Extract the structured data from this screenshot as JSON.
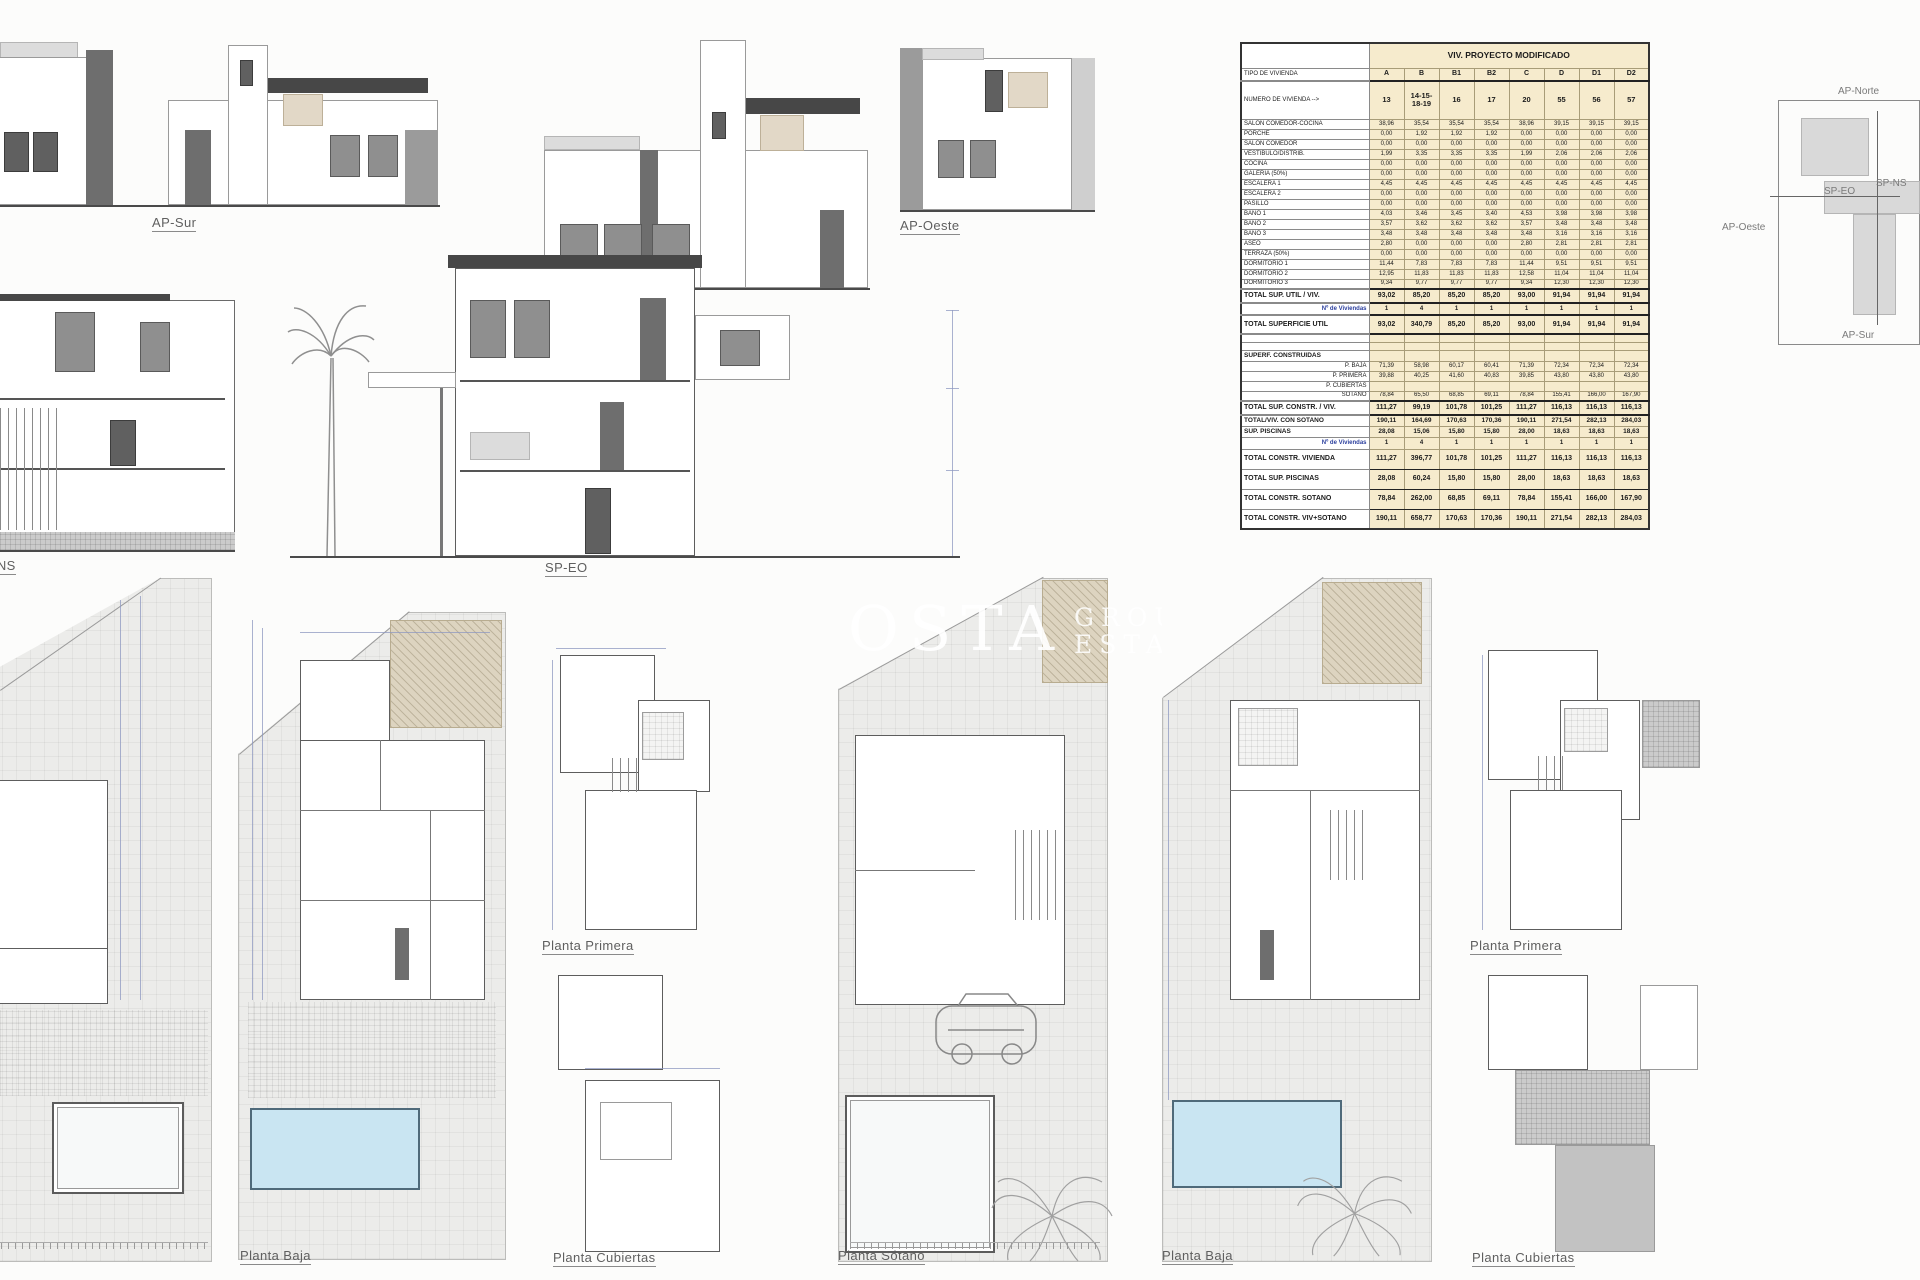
{
  "elevation_labels": {
    "ap_sur": "AP-Sur",
    "ap_norte": "AP-Norte",
    "ap_oeste": "AP-Oeste",
    "sp_ns": "SP-NS",
    "sp_eo": "SP-EO"
  },
  "plan_labels": {
    "sotano_left": "Planta Sótano",
    "baja_left": "Planta Baja",
    "primera_left": "Planta Primera",
    "cubiertas_left": "Planta Cubiertas",
    "sotano_mid": "Planta Sótano",
    "baja_right": "Planta Baja",
    "primera_right": "Planta Primera",
    "cubiertas_right": "Planta Cubiertas"
  },
  "site_key": {
    "ap_norte": "AP-Norte",
    "ap_oeste": "AP-Oeste",
    "ap_sur": "AP-Sur",
    "sp_ns": "SP-NS",
    "sp_eo": "SP-EO"
  },
  "watermark": {
    "big": "OSTA",
    "group": "GROUP",
    "estates": "ESTATES"
  },
  "colors": {
    "table_fill": "#f6ebcd",
    "pool_water": "#c9e5f2",
    "hatch_tan": "#ddd4c0",
    "nviv_blue": "#2b3f9e"
  },
  "table": {
    "title": "VIV. PROYECTO MODIFICADO",
    "rows": [
      {
        "style": "title",
        "label": "",
        "value": "VIV. PROYECTO MODIFICADO"
      },
      {
        "style": "head",
        "label": "TIPO DE VIVIENDA",
        "values": [
          "A",
          "B",
          "B1",
          "B2",
          "C",
          "D",
          "D1",
          "D2"
        ]
      },
      {
        "style": "numero",
        "label": "NUMERO DE VIVIENDA -->",
        "values": [
          "13",
          "14-15-18-19",
          "16",
          "17",
          "20",
          "55",
          "56",
          "57"
        ]
      },
      {
        "style": "room",
        "label": "SALON COMEDOR-COCINA",
        "values": [
          "38,96",
          "35,54",
          "35,54",
          "35,54",
          "38,96",
          "39,15",
          "39,15",
          "39,15"
        ]
      },
      {
        "style": "room",
        "label": "PORCHE",
        "values": [
          "0,00",
          "1,92",
          "1,92",
          "1,92",
          "0,00",
          "0,00",
          "0,00",
          "0,00"
        ]
      },
      {
        "style": "room",
        "label": "SALON COMEDOR",
        "values": [
          "0,00",
          "0,00",
          "0,00",
          "0,00",
          "0,00",
          "0,00",
          "0,00",
          "0,00"
        ]
      },
      {
        "style": "room",
        "label": "VESTIBULO/DISTRIB.",
        "values": [
          "1,99",
          "3,35",
          "3,35",
          "3,35",
          "1,99",
          "2,06",
          "2,06",
          "2,06"
        ]
      },
      {
        "style": "room",
        "label": "COCINA",
        "values": [
          "0,00",
          "0,00",
          "0,00",
          "0,00",
          "0,00",
          "0,00",
          "0,00",
          "0,00"
        ]
      },
      {
        "style": "room",
        "label": "GALERIA (50%)",
        "values": [
          "0,00",
          "0,00",
          "0,00",
          "0,00",
          "0,00",
          "0,00",
          "0,00",
          "0,00"
        ]
      },
      {
        "style": "room",
        "label": "ESCALERA 1",
        "values": [
          "4,45",
          "4,45",
          "4,45",
          "4,45",
          "4,45",
          "4,45",
          "4,45",
          "4,45"
        ]
      },
      {
        "style": "room",
        "label": "ESCALERA 2",
        "values": [
          "0,00",
          "0,00",
          "0,00",
          "0,00",
          "0,00",
          "0,00",
          "0,00",
          "0,00"
        ]
      },
      {
        "style": "room",
        "label": "PASILLO",
        "values": [
          "0,00",
          "0,00",
          "0,00",
          "0,00",
          "0,00",
          "0,00",
          "0,00",
          "0,00"
        ]
      },
      {
        "style": "room",
        "label": "BAÑO 1",
        "values": [
          "4,03",
          "3,46",
          "3,45",
          "3,40",
          "4,53",
          "3,98",
          "3,98",
          "3,98"
        ]
      },
      {
        "style": "room",
        "label": "BAÑO 2",
        "values": [
          "3,57",
          "3,62",
          "3,62",
          "3,62",
          "3,57",
          "3,48",
          "3,48",
          "3,48"
        ]
      },
      {
        "style": "room",
        "label": "BAÑO 3",
        "values": [
          "3,48",
          "3,48",
          "3,48",
          "3,48",
          "3,48",
          "3,16",
          "3,16",
          "3,16"
        ]
      },
      {
        "style": "room",
        "label": "ASEO",
        "values": [
          "2,80",
          "0,00",
          "0,00",
          "0,00",
          "2,80",
          "2,81",
          "2,81",
          "2,81"
        ]
      },
      {
        "style": "room",
        "label": "TERRAZA (50%)",
        "values": [
          "0,00",
          "0,00",
          "0,00",
          "0,00",
          "0,00",
          "0,00",
          "0,00",
          "0,00"
        ]
      },
      {
        "style": "room",
        "label": "DORMITORIO 1",
        "values": [
          "11,44",
          "7,83",
          "7,83",
          "7,83",
          "11,44",
          "9,51",
          "9,51",
          "9,51"
        ]
      },
      {
        "style": "room",
        "label": "DORMITORIO 2",
        "values": [
          "12,95",
          "11,83",
          "11,83",
          "11,83",
          "12,58",
          "11,04",
          "11,04",
          "11,04"
        ]
      },
      {
        "style": "room",
        "label": "DORMITORIO 3",
        "values": [
          "9,34",
          "9,77",
          "9,77",
          "9,77",
          "9,34",
          "12,30",
          "12,30",
          "12,30"
        ]
      },
      {
        "style": "total",
        "label": "TOTAL SUP. UTIL / VIV.",
        "values": [
          "93,02",
          "85,20",
          "85,20",
          "85,20",
          "93,00",
          "91,94",
          "91,94",
          "91,94"
        ]
      },
      {
        "style": "nviv",
        "label": "Nº de Viviendas",
        "values": [
          "1",
          "4",
          "1",
          "1",
          "1",
          "1",
          "1",
          "1"
        ]
      },
      {
        "style": "tsu",
        "label": "TOTAL SUPERFICIE UTIL",
        "values": [
          "93,02",
          "340,79",
          "85,20",
          "85,20",
          "93,00",
          "91,94",
          "91,94",
          "91,94"
        ]
      },
      {
        "style": "spacer",
        "label": "",
        "values": [
          "",
          "",
          "",
          "",
          "",
          "",
          "",
          ""
        ]
      },
      {
        "style": "spacer",
        "label": "",
        "values": [
          "",
          "",
          "",
          "",
          "",
          "",
          "",
          ""
        ]
      },
      {
        "style": "section",
        "label": "SUPERF. CONSTRUIDAS",
        "values": [
          "",
          "",
          "",
          "",
          "",
          "",
          "",
          ""
        ]
      },
      {
        "style": "sub",
        "label": "P. BAJA",
        "values": [
          "71,39",
          "58,98",
          "60,17",
          "60,41",
          "71,39",
          "72,34",
          "72,34",
          "72,34"
        ]
      },
      {
        "style": "sub",
        "label": "P. PRIMERA",
        "values": [
          "39,88",
          "40,25",
          "41,60",
          "40,83",
          "39,85",
          "43,80",
          "43,80",
          "43,80"
        ]
      },
      {
        "style": "sub",
        "label": "P. CUBIERTAS",
        "values": [
          "",
          "",
          "",
          "",
          "",
          "",
          "",
          ""
        ]
      },
      {
        "style": "sub",
        "label": "SOTANO",
        "values": [
          "78,84",
          "65,50",
          "68,85",
          "69,11",
          "78,84",
          "155,41",
          "166,00",
          "167,90"
        ]
      },
      {
        "style": "constr",
        "label": "TOTAL SUP. CONSTR. / VIV.",
        "values": [
          "111,27",
          "99,19",
          "101,78",
          "101,25",
          "111,27",
          "116,13",
          "116,13",
          "116,13"
        ]
      },
      {
        "style": "bold",
        "label": "TOTAL/VIV. CON SOTANO",
        "values": [
          "190,11",
          "164,69",
          "170,63",
          "170,36",
          "190,11",
          "271,54",
          "282,13",
          "284,03"
        ]
      },
      {
        "style": "bold",
        "label": "SUP. PISCINAS",
        "values": [
          "28,08",
          "15,06",
          "15,80",
          "15,80",
          "28,00",
          "18,63",
          "18,63",
          "18,63"
        ]
      },
      {
        "style": "nviv",
        "label": "Nº de Viviendas",
        "values": [
          "1",
          "4",
          "1",
          "1",
          "1",
          "1",
          "1",
          "1"
        ]
      },
      {
        "style": "grand",
        "label": "TOTAL CONSTR. VIVIENDA",
        "values": [
          "111,27",
          "396,77",
          "101,78",
          "101,25",
          "111,27",
          "116,13",
          "116,13",
          "116,13"
        ]
      },
      {
        "style": "grand",
        "label": "TOTAL SUP. PISCINAS",
        "values": [
          "28,08",
          "60,24",
          "15,80",
          "15,80",
          "28,00",
          "18,63",
          "18,63",
          "18,63"
        ]
      },
      {
        "style": "grand",
        "label": "TOTAL CONSTR. SOTANO",
        "values": [
          "78,84",
          "262,00",
          "68,85",
          "69,11",
          "78,84",
          "155,41",
          "166,00",
          "167,90"
        ]
      },
      {
        "style": "grand",
        "label": "TOTAL CONSTR. VIV+SOTANO",
        "values": [
          "190,11",
          "658,77",
          "170,63",
          "170,36",
          "190,11",
          "271,54",
          "282,13",
          "284,03"
        ]
      }
    ]
  }
}
